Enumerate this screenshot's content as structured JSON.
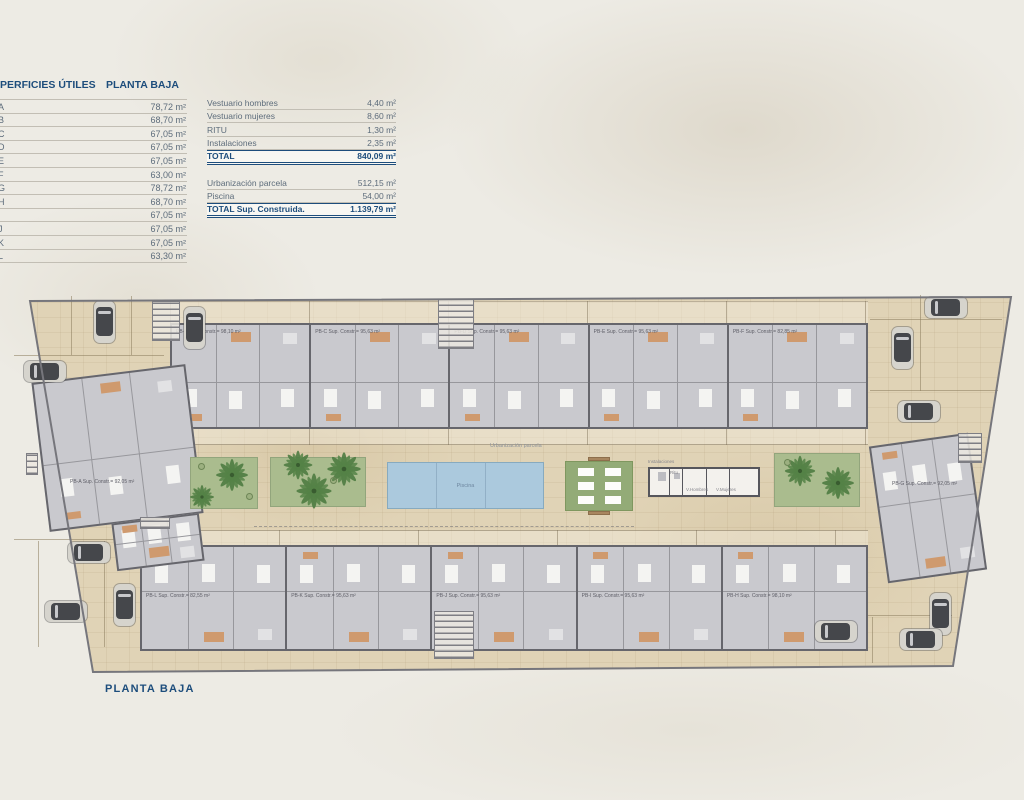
{
  "page": {
    "background": "#edebe4"
  },
  "left_table": {
    "title": "PERFICIES ÚTILES",
    "subtitle": "PLANTA BAJA",
    "rows": [
      {
        "letter": "A",
        "value": "78,72 m²"
      },
      {
        "letter": "B",
        "value": "68,70 m²"
      },
      {
        "letter": "C",
        "value": "67,05 m²"
      },
      {
        "letter": "D",
        "value": "67,05 m²"
      },
      {
        "letter": "E",
        "value": "67,05 m²"
      },
      {
        "letter": "F",
        "value": "63,00 m²"
      },
      {
        "letter": "G",
        "value": "78,72 m²"
      },
      {
        "letter": "H",
        "value": "68,70 m²"
      },
      {
        "letter": "I",
        "value": "67,05 m²"
      },
      {
        "letter": "J",
        "value": "67,05 m²"
      },
      {
        "letter": "K",
        "value": "67,05 m²"
      },
      {
        "letter": "L",
        "value": "63,30 m²"
      }
    ]
  },
  "summary_table": {
    "rows_building": [
      {
        "label": "Vestuario hombres",
        "value": "4,40 m²"
      },
      {
        "label": "Vestuario mujeres",
        "value": "8,60 m²"
      },
      {
        "label": "RITU",
        "value": "1,30 m²"
      },
      {
        "label": "Instalaciones",
        "value": "2,35 m²"
      }
    ],
    "total_building": {
      "label": "TOTAL",
      "value": "840,09 m²"
    },
    "rows_site": [
      {
        "label": "Urbanización parcela",
        "value": "512,15 m²"
      },
      {
        "label": "Piscina",
        "value": "54,00 m²"
      }
    ],
    "total_site": {
      "label": "TOTAL Sup. Construida.",
      "value": "1.139,79 m²"
    }
  },
  "plan": {
    "caption": "PLANTA BAJA",
    "site_label": "Urbanización parcela",
    "pool_label": "Piscina",
    "services": {
      "title": "Instalaciones",
      "rooms": [
        "Ritu",
        "V.Hombres",
        "V.Mujeres"
      ]
    },
    "unit_left": {
      "label": "PB-A Sup. Constr.= 92,05 m²"
    },
    "unit_right": {
      "label": "PB-G Sup. Constr.= 92,05 m²"
    },
    "units_top": [
      {
        "label": "PB-B Sup. Constr.= 98,10 m²"
      },
      {
        "label": "PB-C Sup. Constr.= 95,63 m²"
      },
      {
        "label": "PB-D Sup. Constr.= 95,63 m²"
      },
      {
        "label": "PB-E Sup. Constr.= 95,63 m²"
      },
      {
        "label": "PB-F Sup. Constr.= 82,85 m²"
      }
    ],
    "units_bottom": [
      {
        "label": "PB-L Sup. Constr.= 82,55 m²"
      },
      {
        "label": "PB-K Sup. Constr.= 95,63 m²"
      },
      {
        "label": "PB-J Sup. Constr.= 95,63 m²"
      },
      {
        "label": "PB-I Sup. Constr.= 95,63 m²"
      },
      {
        "label": "PB-H Sup. Constr.= 98,10 m²"
      }
    ],
    "colors": {
      "accent_navy": "#1d4d7c",
      "ground": "#e0d3b6",
      "building": "#c9c9ce",
      "wall": "#66666c",
      "pool": "#abc9dd",
      "garden": "#aabc8e",
      "palm": "#4e7b41",
      "terracotta": "#cf9a6e"
    }
  }
}
